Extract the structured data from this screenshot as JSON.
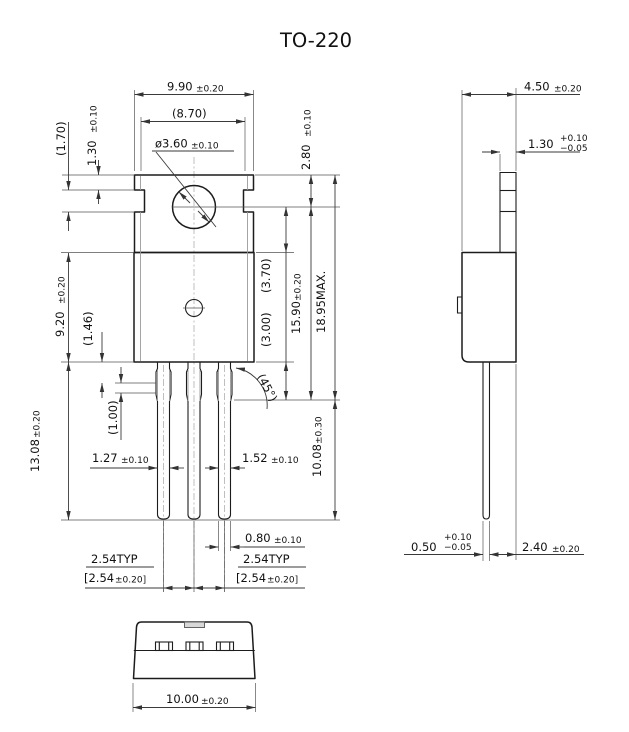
{
  "title": "TO-220",
  "front_view": {
    "tab_width": {
      "value": "9.90",
      "tol": "±0.20"
    },
    "face_width": {
      "value": "(8.70)"
    },
    "hole_dia": {
      "value": "ø3.60",
      "tol": "±0.10"
    },
    "tab_top_to_hole": {
      "value": "2.80",
      "tol": "±0.10"
    },
    "tab_top_to_notch": {
      "value": "1.30",
      "tol": "±0.10"
    },
    "notch_height": {
      "value": "(1.70)"
    },
    "body_height": {
      "value": "9.20",
      "tol": "±0.20"
    },
    "lead_neck": {
      "value": "(1.46)"
    },
    "lead_shoulder": {
      "value": "(1.00)"
    },
    "lead_length": {
      "value": "13.08",
      "tol": "±0.20"
    },
    "lead1_width": {
      "value": "1.27",
      "tol": "±0.10"
    },
    "lead3_width": {
      "value": "1.52",
      "tol": "±0.10"
    },
    "hole_to_body_top": {
      "value": "(3.70)"
    },
    "shoulder_length": {
      "value": "(3.00)"
    },
    "hole_to_shoulder": {
      "value": "15.90",
      "tol": "±0.20"
    },
    "overall_height": {
      "value": "18.95MAX."
    },
    "lead_free_length": {
      "value": "10.08",
      "tol": "±0.30"
    },
    "chamfer_angle": {
      "value": "(45°)"
    },
    "lead_tip_width": {
      "value": "0.80",
      "tol": "±0.10"
    },
    "pitch_left": {
      "typ": "2.54TYP",
      "bracket_value": "[2.54",
      "bracket_tol": "±0.20]"
    },
    "pitch_right": {
      "typ": "2.54TYP",
      "bracket_value": "[2.54",
      "bracket_tol": "±0.20]"
    }
  },
  "side_view": {
    "body_depth": {
      "value": "4.50",
      "tol": "±0.20"
    },
    "tab_thickness": {
      "value": "1.30",
      "tol_plus": "+0.10",
      "tol_minus": "−0.05"
    },
    "lead_thickness": {
      "value": "0.50",
      "tol_plus": "+0.10",
      "tol_minus": "−0.05"
    },
    "lead_to_back": {
      "value": "2.40",
      "tol": "±0.20"
    }
  },
  "bottom_view": {
    "body_width": {
      "value": "10.00",
      "tol": "±0.20"
    }
  }
}
